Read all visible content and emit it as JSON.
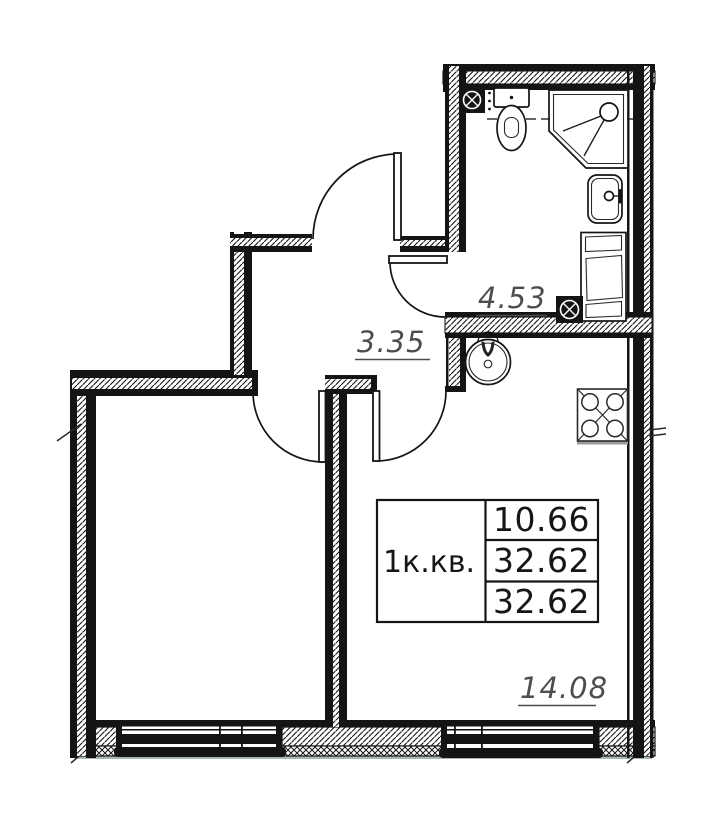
{
  "plan": {
    "type": "apartment-floor-plan",
    "table": {
      "apartment_label": "1к.кв.",
      "values": [
        "10.66",
        "32.62",
        "32.62"
      ]
    },
    "areas": {
      "bathroom": "4.53",
      "hallway": "3.35",
      "living_room": "14.08"
    },
    "colors": {
      "wall": "#141414",
      "area_label": "#4d4d4d",
      "terrace_line": "#a9b6b4",
      "stove_shadow": "#9b9b9b"
    }
  }
}
